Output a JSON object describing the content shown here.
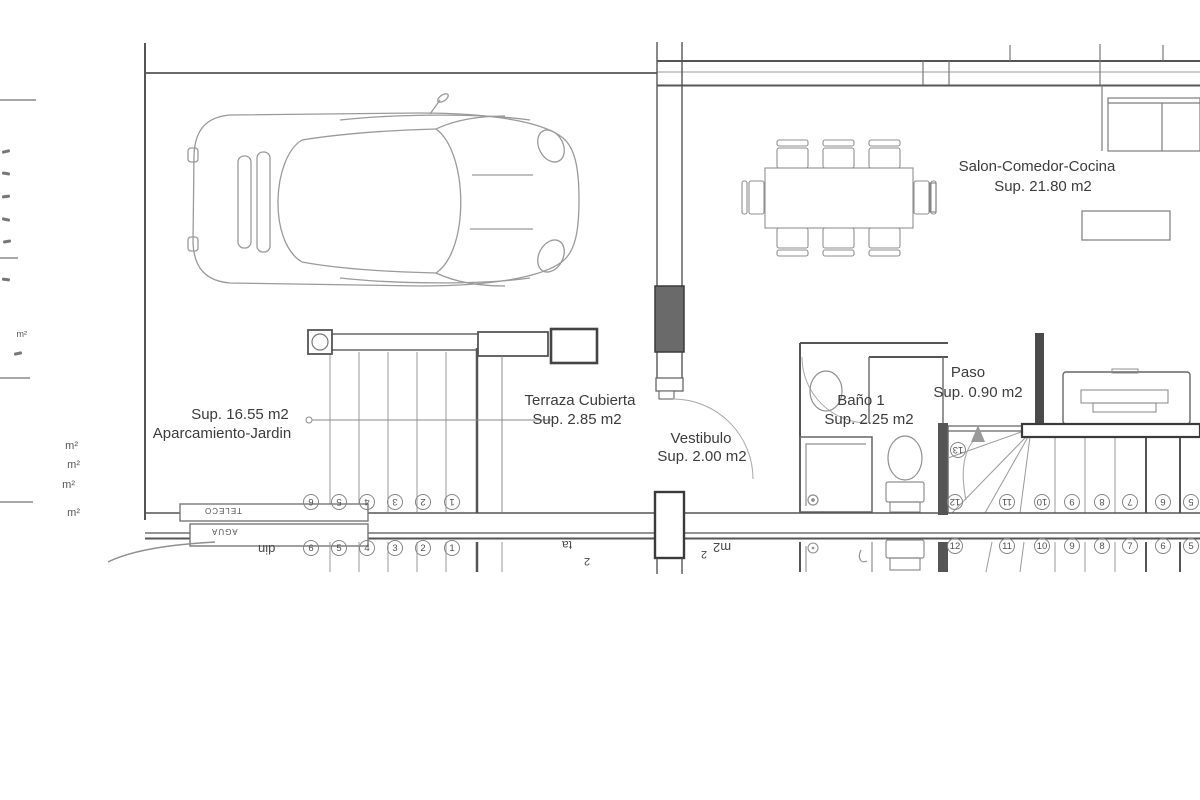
{
  "rooms": {
    "salon": {
      "name": "Salon-Comedor-Cocina",
      "area": "Sup. 21.80 m2"
    },
    "aparcamiento": {
      "area": "Sup. 16.55 m2",
      "name": "Aparcamiento-Jardin"
    },
    "terraza": {
      "name": "Terraza Cubierta",
      "area": "Sup. 2.85 m2"
    },
    "vestibulo": {
      "name": "Vestibulo",
      "area": "Sup. 2.00 m2"
    },
    "bano": {
      "name": "Baño 1",
      "area": "Sup. 2.25 m2"
    },
    "paso": {
      "name": "Paso",
      "area": "Sup. 0.90 m2"
    }
  },
  "utilities": {
    "teleco": "TELECO",
    "agua": "AGUA"
  },
  "stairs": {
    "top_step": "13",
    "garage_steps": [
      "6",
      "5",
      "4",
      "3",
      "2",
      "1"
    ],
    "garage_steps_mirror": [
      "6",
      "5",
      "4",
      "3",
      "2",
      "1"
    ],
    "main_steps": [
      "12",
      "11",
      "10",
      "9",
      "8",
      "7",
      "6",
      "5"
    ],
    "main_steps_mirror": [
      "12",
      "11",
      "10",
      "9",
      "8",
      "7",
      "6",
      "5"
    ]
  },
  "mirror_fragments": {
    "jardin": "din",
    "terraza_end": "ta",
    "terraza_sup": "2",
    "vestibulo_sup": "2",
    "vestibulo_unit": "m2"
  },
  "legend_fragments": {
    "u1": "m²",
    "u2": "m²",
    "u3": "m²",
    "u4": "m²",
    "u5": "m²"
  },
  "colors": {
    "wall": "#4d4d4d",
    "furniture": "#8f8f8f",
    "text": "#3c3c3c",
    "background": "#ffffff"
  }
}
